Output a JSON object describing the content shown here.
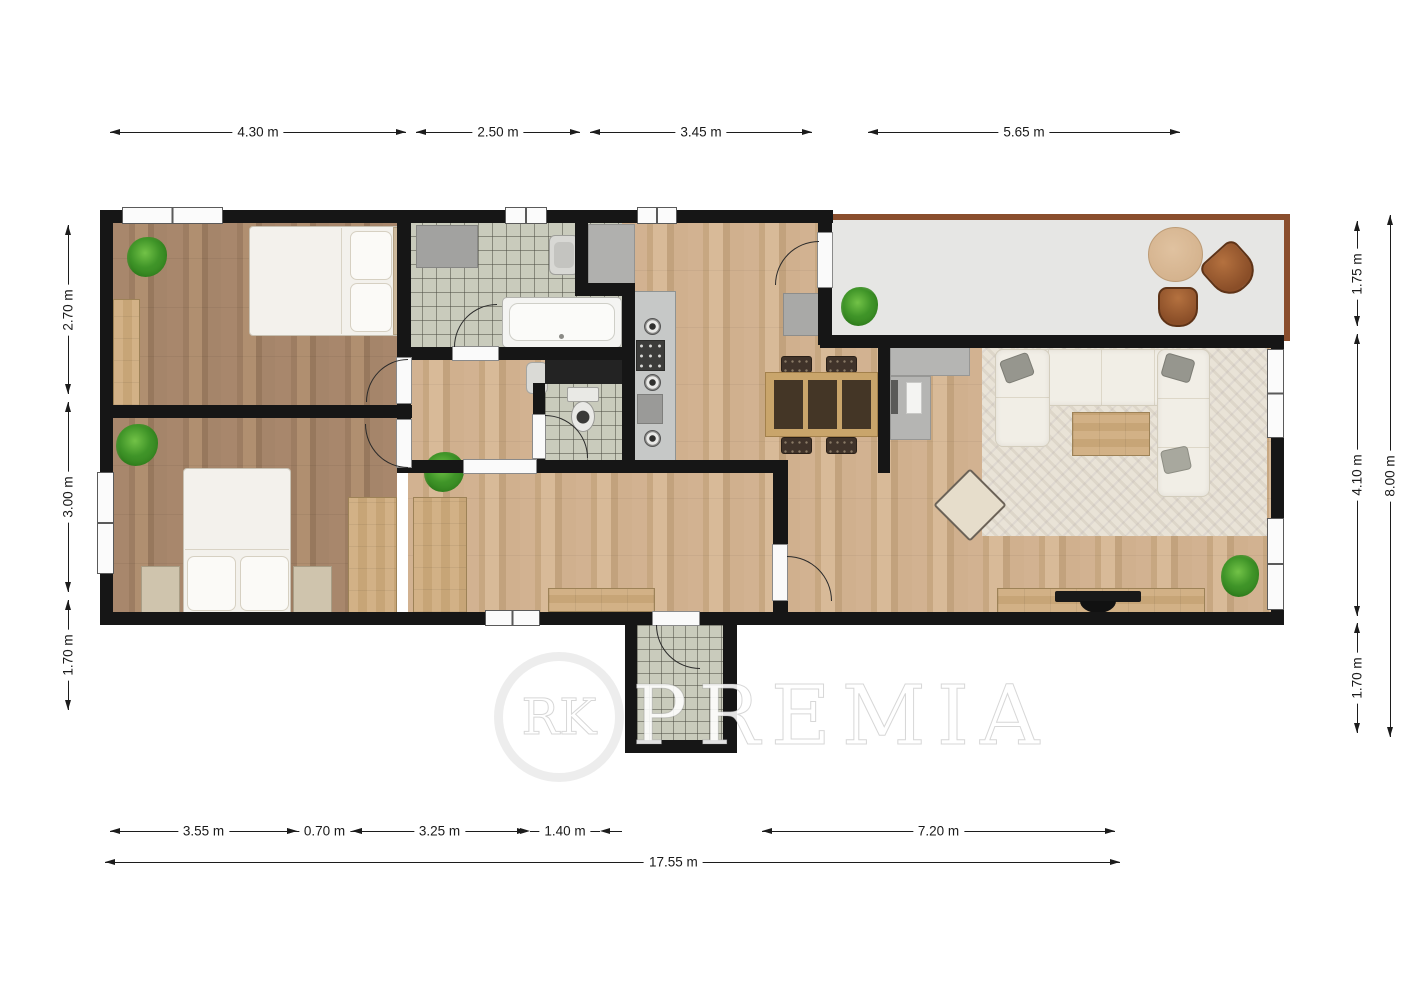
{
  "watermark": {
    "circle_text": "RK",
    "brand_text": "PREMIA"
  },
  "plan": {
    "type": "floor_plan",
    "total_width_label": "17.55 m",
    "total_height_label": "8.00 m"
  },
  "colors": {
    "wall": "#161616",
    "floor_light_wood": "#cdad8b",
    "floor_dark_wood": "#a5866b",
    "tile": "#c9cbbc",
    "terrace_floor": "#e6e6e4",
    "terrace_border": "#8a4e2d",
    "furniture_wood": "#cbaa7e",
    "dimension_line": "#1c1c1c"
  },
  "dimensions": [
    {
      "id": "top-1",
      "label": "4.30 m",
      "orient": "h",
      "at": 132,
      "from": 110,
      "to": 406,
      "style": "in"
    },
    {
      "id": "top-2",
      "label": "2.50 m",
      "orient": "h",
      "at": 132,
      "from": 416,
      "to": 580,
      "style": "in"
    },
    {
      "id": "top-3",
      "label": "3.45 m",
      "orient": "h",
      "at": 132,
      "from": 590,
      "to": 812,
      "style": "in"
    },
    {
      "id": "top-4",
      "label": "5.65 m",
      "orient": "h",
      "at": 132,
      "from": 868,
      "to": 1180,
      "style": "in"
    },
    {
      "id": "left-1",
      "label": "2.70 m",
      "orient": "v",
      "at": 68,
      "from": 225,
      "to": 394,
      "style": "in"
    },
    {
      "id": "left-2",
      "label": "3.00 m",
      "orient": "v",
      "at": 68,
      "from": 402,
      "to": 592,
      "style": "in"
    },
    {
      "id": "left-3",
      "label": "1.70 m",
      "orient": "v",
      "at": 68,
      "from": 600,
      "to": 710,
      "style": "in"
    },
    {
      "id": "right-1",
      "label": "1.75 m",
      "orient": "v",
      "at": 1357,
      "from": 221,
      "to": 326,
      "style": "in"
    },
    {
      "id": "right-2",
      "label": "4.10 m",
      "orient": "v",
      "at": 1357,
      "from": 334,
      "to": 616,
      "style": "in"
    },
    {
      "id": "right-3",
      "label": "1.70 m",
      "orient": "v",
      "at": 1357,
      "from": 623,
      "to": 733,
      "style": "in"
    },
    {
      "id": "right-total",
      "label": "8.00 m",
      "orient": "v",
      "at": 1390,
      "from": 215,
      "to": 737,
      "style": "in"
    },
    {
      "id": "bottom-1",
      "label": "3.55 m",
      "orient": "h",
      "at": 831,
      "from": 110,
      "to": 297,
      "style": "in"
    },
    {
      "id": "bottom-2",
      "label": "0.70 m",
      "orient": "h",
      "at": 831,
      "from": 297,
      "to": 352,
      "style": "out"
    },
    {
      "id": "bottom-3",
      "label": "3.25 m",
      "orient": "h",
      "at": 831,
      "from": 352,
      "to": 527,
      "style": "in"
    },
    {
      "id": "bottom-4",
      "label": "1.40 m",
      "orient": "h",
      "at": 831,
      "from": 530,
      "to": 600,
      "style": "out"
    },
    {
      "id": "bottom-5",
      "label": "7.20 m",
      "orient": "h",
      "at": 831,
      "from": 762,
      "to": 1115,
      "style": "in"
    },
    {
      "id": "bottom-total",
      "label": "17.55 m",
      "orient": "h",
      "at": 862,
      "from": 105,
      "to": 1120,
      "style": "in",
      "label_pos": 0.56
    }
  ]
}
